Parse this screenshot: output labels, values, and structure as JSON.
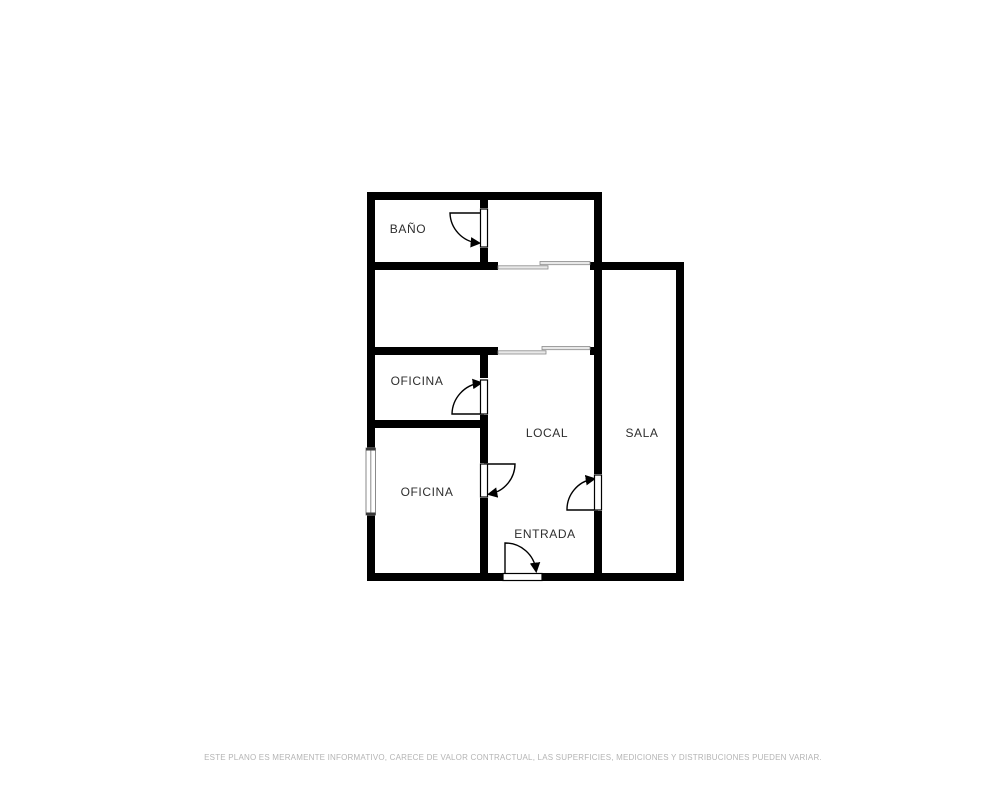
{
  "plan": {
    "rooms": [
      {
        "id": "bano",
        "label": "BAÑO"
      },
      {
        "id": "oficina-top",
        "label": "OFICINA"
      },
      {
        "id": "oficina-bottom",
        "label": "OFICINA"
      },
      {
        "id": "local",
        "label": "LOCAL"
      },
      {
        "id": "sala",
        "label": "SALA"
      },
      {
        "id": "entrada",
        "label": "ENTRADA"
      }
    ],
    "colors": {
      "wall": "#000000",
      "background": "#ffffff",
      "label": "#2e2e2e",
      "sliding_door": "#e8e8e8",
      "disclaimer": "#b4b4b4"
    }
  },
  "footer": {
    "disclaimer": "ESTE PLANO ES MERAMENTE INFORMATIVO, CARECE DE VALOR CONTRACTUAL, LAS SUPERFICIES, MEDICIONES Y DISTRIBUCIONES PUEDEN VARIAR."
  }
}
